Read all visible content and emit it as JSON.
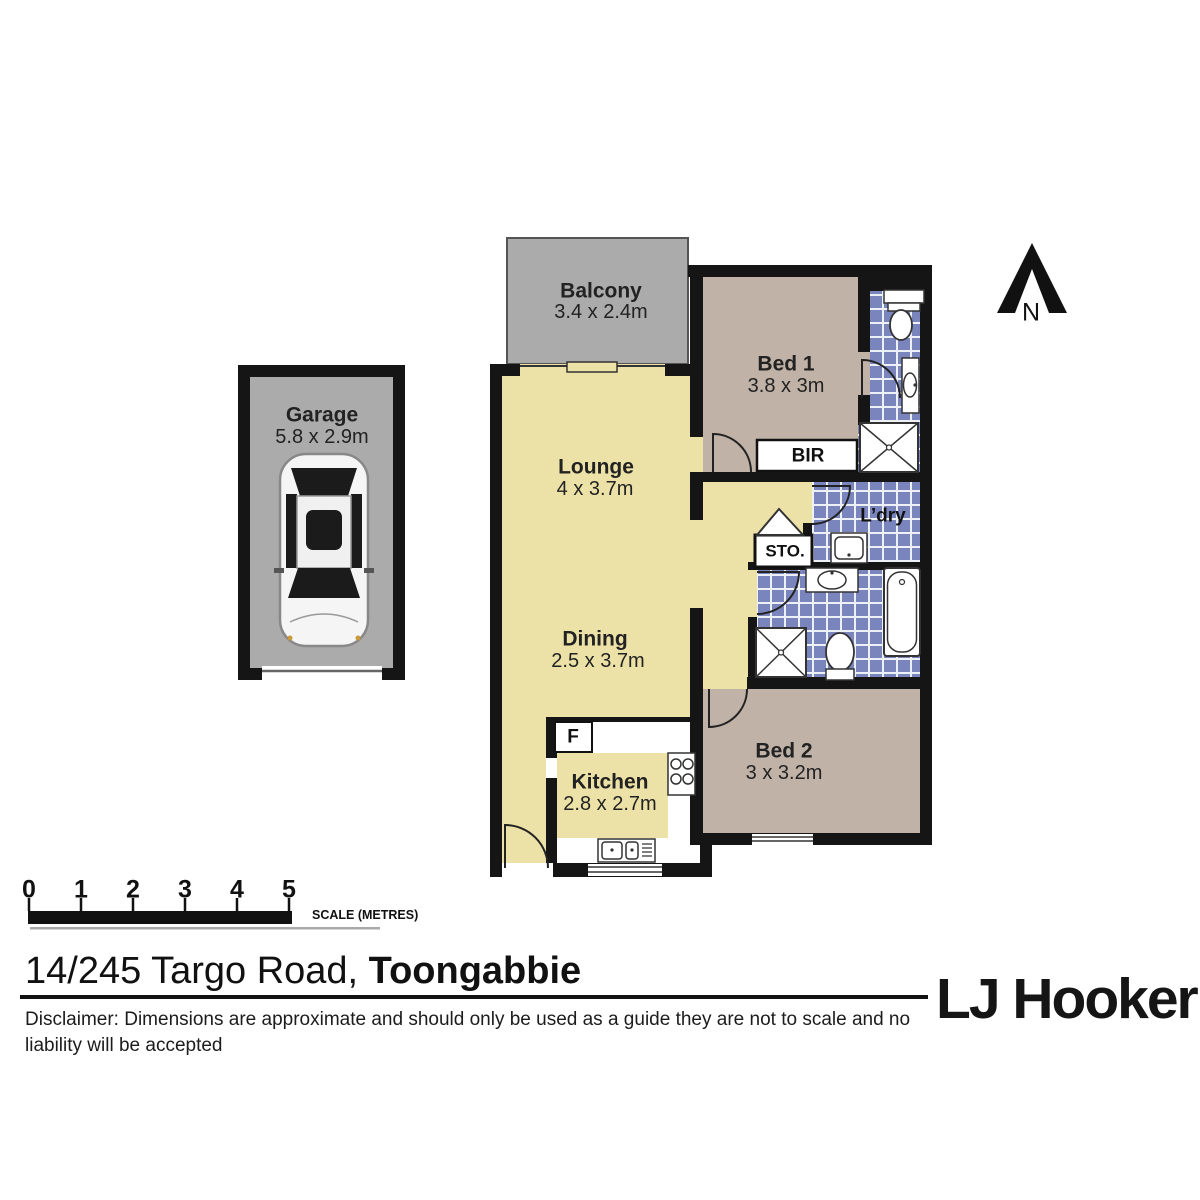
{
  "north": {
    "label": "N"
  },
  "rooms": {
    "balcony": {
      "name": "Balcony",
      "dims": "3.4 x 2.4m"
    },
    "bed1": {
      "name": "Bed 1",
      "dims": "3.8 x 3m"
    },
    "garage": {
      "name": "Garage",
      "dims": "5.8 x 2.9m"
    },
    "lounge": {
      "name": "Lounge",
      "dims": "4 x 3.7m"
    },
    "dining": {
      "name": "Dining",
      "dims": "2.5 x 3.7m"
    },
    "kitchen": {
      "name": "Kitchen",
      "dims": "2.8 x 2.7m"
    },
    "bed2": {
      "name": "Bed 2",
      "dims": "3 x 3.2m"
    },
    "laundry": {
      "name": "L’dry"
    },
    "bir": {
      "name": "BIR"
    },
    "storage": {
      "name": "STO."
    },
    "fridge": {
      "name": "F"
    }
  },
  "scale_bar": {
    "ticks": [
      "0",
      "1",
      "2",
      "3",
      "4",
      "5"
    ],
    "label": "SCALE (METRES)"
  },
  "footer": {
    "address_prefix": "14/245 Targo Road, ",
    "address_suburb": "Toongabbie",
    "disclaimer": "Disclaimer: Dimensions are approximate and should only be used as a guide they are not to scale and no liability will be accepted",
    "logo": "LJ Hooker"
  },
  "colors": {
    "floor_living": "#ECE2A7",
    "floor_bedroom": "#C0B2A6",
    "floor_outdoor": "#ABABAB",
    "tile_blue": "#7B85BD",
    "wall": "#151515"
  }
}
